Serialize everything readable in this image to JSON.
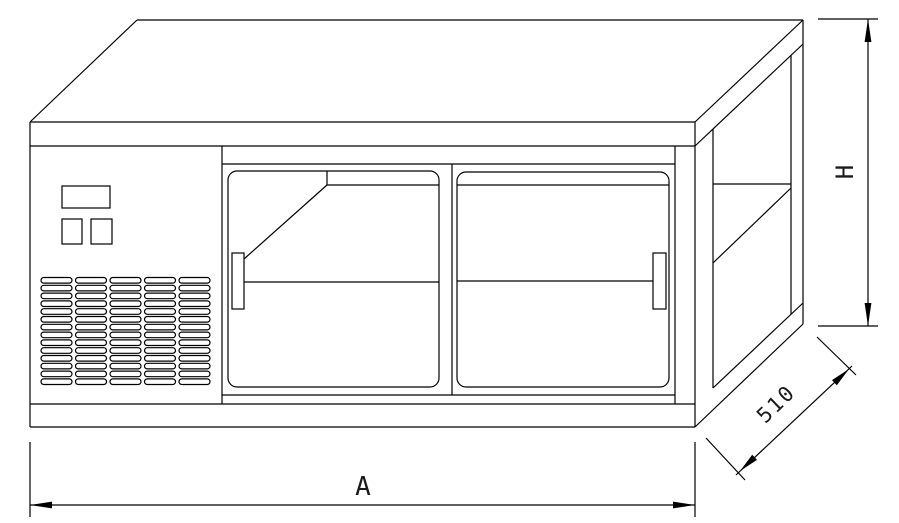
{
  "drawing": {
    "subject": "refrigerated counter isometric line drawing",
    "colors": {
      "background": "#ffffff",
      "line": "#000000"
    },
    "dimensions": {
      "height_label": "H",
      "depth_label": "510",
      "width_label": "A"
    },
    "grille": {
      "rows": 14,
      "columns": 5
    },
    "doors": {
      "count": 2
    }
  }
}
